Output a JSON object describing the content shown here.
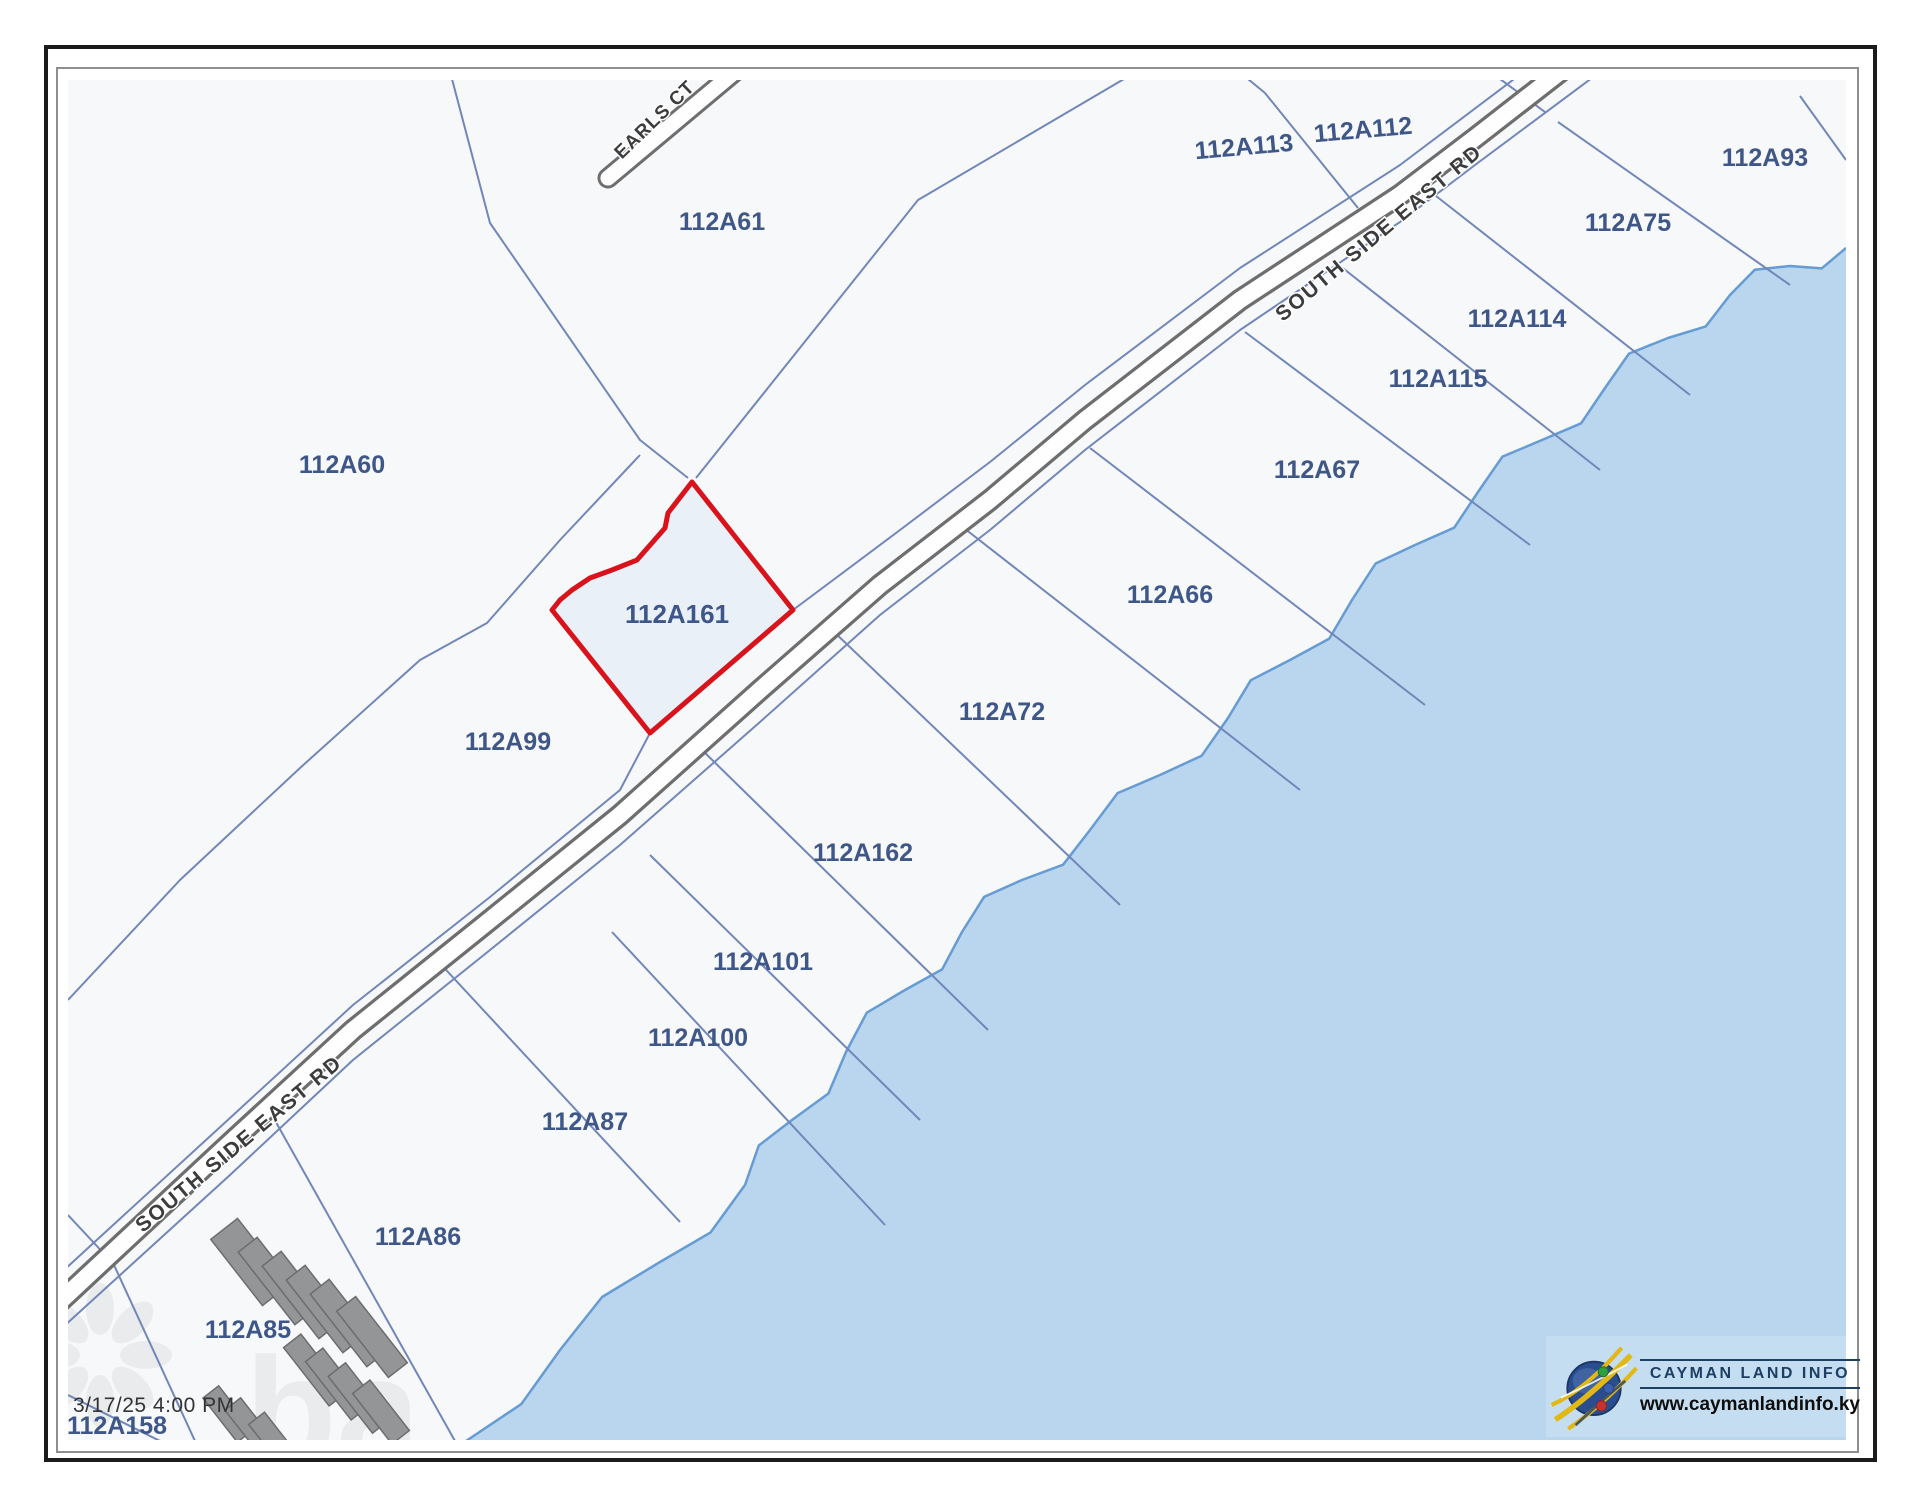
{
  "page": {
    "timestamp": "3/17/25 4:00 PM"
  },
  "logo": {
    "title": "CAYMAN LAND INFO",
    "url": "www.caymanlandinfo.ky"
  },
  "colors": {
    "land": "#f7f8fa",
    "water": "#b9d6ee",
    "coast": "#669bd4",
    "parcel_line": "#7187b9",
    "road_casing": "#6e6e6e",
    "road_fill": "#fefefe",
    "label": "#3e5688",
    "road_text": "#3c3c3c",
    "selected_stroke": "#d8131b",
    "selected_fill": "#eaf0f8",
    "building": "#939596",
    "building_stroke": "#6b6d6e",
    "frame": "#1b1b1b",
    "frame_inner": "#8e8e8e",
    "logo_box": "#c5ddf1",
    "logo_navy": "#1d3f63",
    "watermark": "#e9eaec"
  },
  "map": {
    "road_name": "SOUTH SIDE EAST RD",
    "street_name": "EARLS CT",
    "selected_parcel": {
      "id": "112A161",
      "label_x": 677,
      "label_y": 614,
      "points": "692,482 668,513 665,528 637,560 612,570 590,578 572,590 560,600 552,610 650,733 793,610"
    },
    "parcel_labels": [
      {
        "id": "112A60",
        "x": 342,
        "y": 465,
        "r": 0
      },
      {
        "id": "112A61",
        "x": 722,
        "y": 222,
        "r": 0
      },
      {
        "id": "112A99",
        "x": 508,
        "y": 742,
        "r": 0
      },
      {
        "id": "112A113",
        "x": 1244,
        "y": 147,
        "r": -5
      },
      {
        "id": "112A112",
        "x": 1363,
        "y": 130,
        "r": -5
      },
      {
        "id": "112A93",
        "x": 1765,
        "y": 158,
        "r": 0
      },
      {
        "id": "112A75",
        "x": 1628,
        "y": 223,
        "r": 0
      },
      {
        "id": "112A114",
        "x": 1517,
        "y": 319,
        "r": 0
      },
      {
        "id": "112A115",
        "x": 1438,
        "y": 379,
        "r": 0
      },
      {
        "id": "112A67",
        "x": 1317,
        "y": 470,
        "r": 0
      },
      {
        "id": "112A66",
        "x": 1170,
        "y": 595,
        "r": 0
      },
      {
        "id": "112A72",
        "x": 1002,
        "y": 712,
        "r": 0
      },
      {
        "id": "112A162",
        "x": 863,
        "y": 853,
        "r": 0
      },
      {
        "id": "112A101",
        "x": 763,
        "y": 962,
        "r": 0
      },
      {
        "id": "112A100",
        "x": 698,
        "y": 1038,
        "r": 0
      },
      {
        "id": "112A87",
        "x": 585,
        "y": 1122,
        "r": 0
      },
      {
        "id": "112A86",
        "x": 418,
        "y": 1237,
        "r": 0
      },
      {
        "id": "112A85",
        "x": 248,
        "y": 1330,
        "r": 0
      },
      {
        "id": "112A158",
        "x": 117,
        "y": 1426,
        "r": 0
      }
    ],
    "road_labels": [
      {
        "text": "SOUTH SIDE EAST RD",
        "x": 1379,
        "y": 233,
        "r": -40,
        "cls": "rlabel"
      },
      {
        "text": "SOUTH SIDE EAST RD",
        "x": 239,
        "y": 1144,
        "r": -40,
        "cls": "rlabel"
      },
      {
        "text": "EARLS CT",
        "x": 655,
        "y": 120,
        "r": -44,
        "cls": "slabel"
      }
    ],
    "road_path": "40,1320 230,1143 353,1030 490,920 620,815 760,690 880,585 990,500 1085,420 1240,300 1400,195 1475,138 1565,68",
    "earls_ct_path": "608,178 755,55",
    "boundary_lines": [
      "452,79 490,223 640,440 688,478",
      "640,455 560,540 487,623 420,660 300,768 180,880 68,1000",
      "696,478 918,200 1124,79",
      "1248,79 1265,93 1358,208",
      "1500,79 1545,112",
      "68,1215 108,1258",
      "68,1395 160,1441",
      "40,1292 230,1118 353,1005 490,897 620,790 650,733",
      "793,610 900,530 990,462 1085,385 1240,268 1400,165 1550,52",
      "40,1348 230,1175 353,1060 490,950 620,845 760,722 880,615 990,530 1085,450 1240,330 1400,222 1475,165 1600,72",
      "108,1252 195,1441",
      "268,1108 455,1441",
      "435,958 680,1222",
      "612,932 885,1225",
      "650,855 920,1120",
      "700,748 988,1030",
      "832,630 1120,905",
      "960,525 1300,790",
      "1090,448 1425,705",
      "1245,332 1530,545",
      "1335,262 1600,470",
      "1436,196 1690,395",
      "1558,122 1790,285",
      "1800,96 1846,160"
    ],
    "coast_base": [
      [
        466,
        1441
      ],
      [
        560,
        1350
      ],
      [
        660,
        1262
      ],
      [
        745,
        1185
      ],
      [
        792,
        1120
      ],
      [
        846,
        1052
      ],
      [
        905,
        990
      ],
      [
        962,
        932
      ],
      [
        1022,
        880
      ],
      [
        1090,
        830
      ],
      [
        1160,
        775
      ],
      [
        1228,
        718
      ],
      [
        1290,
        660
      ],
      [
        1352,
        600
      ],
      [
        1415,
        545
      ],
      [
        1478,
        492
      ],
      [
        1542,
        440
      ],
      [
        1605,
        388
      ],
      [
        1668,
        338
      ],
      [
        1730,
        295
      ],
      [
        1790,
        266
      ],
      [
        1846,
        248
      ]
    ],
    "coast_jag_amp": 12,
    "buildings": [
      {
        "x": 250,
        "y": 1262,
        "w": 34,
        "h": 84,
        "r": -38
      },
      {
        "x": 276,
        "y": 1281,
        "w": 24,
        "h": 92,
        "r": -38
      },
      {
        "x": 300,
        "y": 1295,
        "w": 24,
        "h": 92,
        "r": -38
      },
      {
        "x": 324,
        "y": 1309,
        "w": 24,
        "h": 92,
        "r": -38
      },
      {
        "x": 348,
        "y": 1323,
        "w": 24,
        "h": 92,
        "r": -38
      },
      {
        "x": 372,
        "y": 1337,
        "w": 24,
        "h": 84,
        "r": -38
      },
      {
        "x": 315,
        "y": 1370,
        "w": 22,
        "h": 74,
        "r": -38
      },
      {
        "x": 337,
        "y": 1384,
        "w": 22,
        "h": 74,
        "r": -38
      },
      {
        "x": 359,
        "y": 1398,
        "w": 22,
        "h": 72,
        "r": -38
      },
      {
        "x": 381,
        "y": 1412,
        "w": 22,
        "h": 64,
        "r": -38
      },
      {
        "x": 228,
        "y": 1414,
        "w": 20,
        "h": 56,
        "r": -38
      },
      {
        "x": 250,
        "y": 1426,
        "w": 20,
        "h": 56,
        "r": -38
      },
      {
        "x": 272,
        "y": 1438,
        "w": 20,
        "h": 50,
        "r": -38
      }
    ],
    "watermark": {
      "text": "ba",
      "x": 245,
      "y": 1462
    }
  }
}
